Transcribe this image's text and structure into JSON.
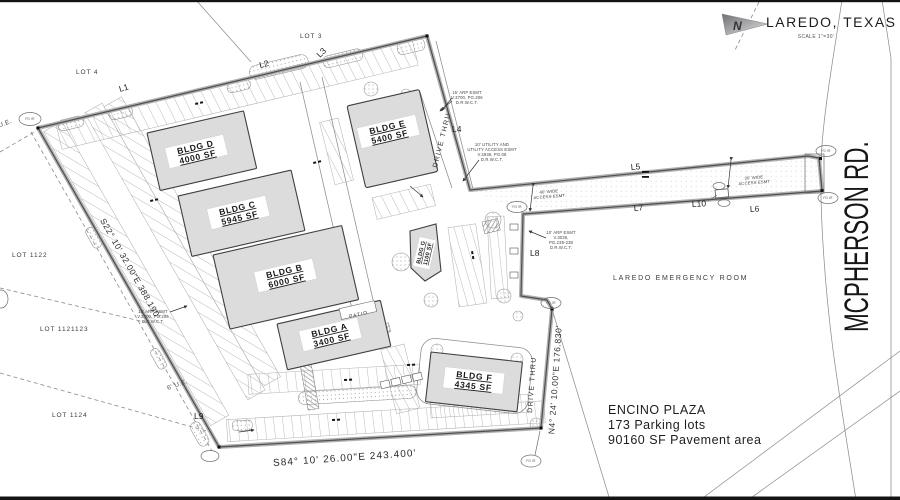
{
  "title_block": {
    "city": "LAREDO, TEXAS",
    "scale": "SCALE 1\"=30'",
    "north_letter": "N"
  },
  "road_name": "MCPHERSON RD.",
  "summary": {
    "name": "ENCINO PLAZA",
    "parking": "173 Parking lots",
    "pavement": "90160 SF Pavement area"
  },
  "adjacent": {
    "emergency_room": "LAREDO EMERGENCY ROOM"
  },
  "buildings": [
    {
      "name": "BLDG A",
      "area": "3400 SF"
    },
    {
      "name": "BLDG B",
      "area": "6000 SF"
    },
    {
      "name": "BLDG C",
      "area": "5945 SF"
    },
    {
      "name": "BLDG D",
      "area": "4000 SF"
    },
    {
      "name": "BLDG E",
      "area": "5400 SF"
    },
    {
      "name": "BLDG F",
      "area": "4345 SF"
    },
    {
      "name": "BLDG G",
      "area": "1100 SF"
    }
  ],
  "lots": {
    "lot3": "LOT 3",
    "lot4": "LOT 4",
    "lot1122": "LOT 1122",
    "lot1121123": "LOT 1121123",
    "lot1124": "LOT 1124"
  },
  "line_labels": {
    "l1": "L1",
    "l2": "L2",
    "l3": "L3",
    "l4": "L4",
    "l5": "L5",
    "l6": "L6",
    "l7": "L7",
    "l8": "L8",
    "l9": "L9",
    "l10": "L10"
  },
  "bearings": {
    "south": "S84° 10' 26.00\"E 243.400'",
    "west": "S22° 10' 32.00\"E 388.190'",
    "east": "N4° 24' 10.00\"E 176.830'"
  },
  "easements": {
    "arp15_ne": [
      "15' ARP ESMT",
      "V.3700, PG.206",
      "D.R.W.C.T."
    ],
    "utility": [
      "10' UTILITY AND",
      "UTILITY ACCESS ESMT",
      "V.4936, PG.08",
      "D.R.W.C.T."
    ],
    "arp10": [
      "10' ARP ESMT",
      "V.3036,",
      "PG.235-238",
      "D.R.W.C.T."
    ],
    "arp15_w": [
      "15' ARP ESMT",
      "V.3700, PG.206",
      "D.R.W.C.T."
    ],
    "access40": [
      "40' WIDE",
      "ACCESS ESMT"
    ],
    "access30": [
      "30' WIDE",
      "ACCESS ESMT"
    ],
    "ue": "6' U.E."
  },
  "annotations": {
    "drive_thru": "DRIVE THRU",
    "patio": "PATIO",
    "fd_ir": "FD IR"
  }
}
